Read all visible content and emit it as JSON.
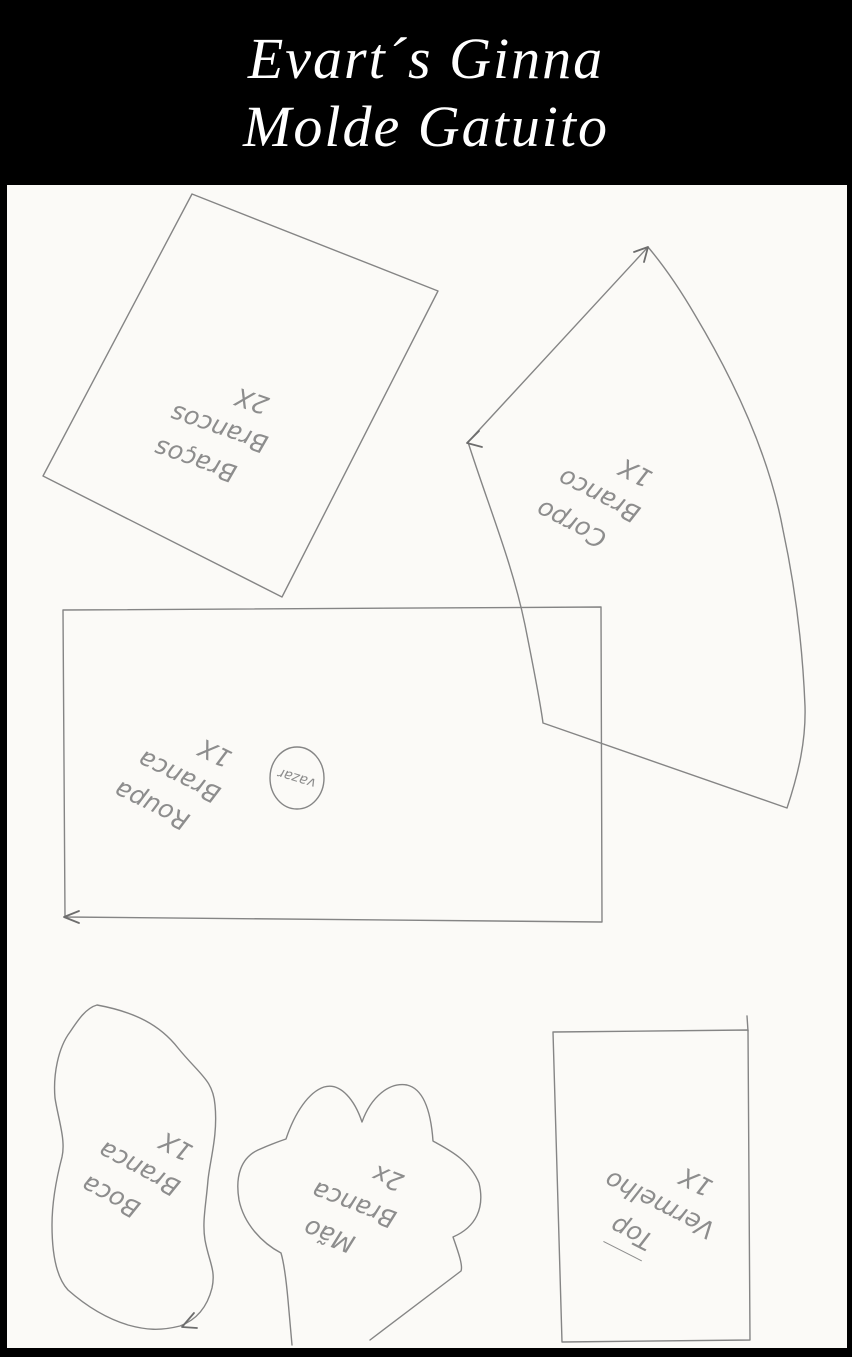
{
  "header": {
    "title_line1": "Evart´s Ginna",
    "title_line2": "Molde Gatuito"
  },
  "pieces": [
    {
      "key": "bracos",
      "name": "Braços",
      "color_label": "Brancos",
      "count": "2X"
    },
    {
      "key": "corpo",
      "name": "Corpo",
      "color_label": "Branco",
      "count": "1X"
    },
    {
      "key": "roupa",
      "name": "Roupa",
      "color_label": "Branca",
      "count": "1X",
      "cutout": "vazar"
    },
    {
      "key": "boca",
      "name": "Boca",
      "color_label": "Branca",
      "count": "1X"
    },
    {
      "key": "mao",
      "name": "Mão",
      "color_label": "Branca",
      "count": "2x"
    },
    {
      "key": "top",
      "name": "Top",
      "color_label": "Vermelho",
      "count": "1X",
      "name_underlined": true
    }
  ],
  "colors": {
    "banner_background": "#000000",
    "title_text": "#ffffff",
    "paper": "#fbfaf7",
    "pencil": "#858585"
  }
}
